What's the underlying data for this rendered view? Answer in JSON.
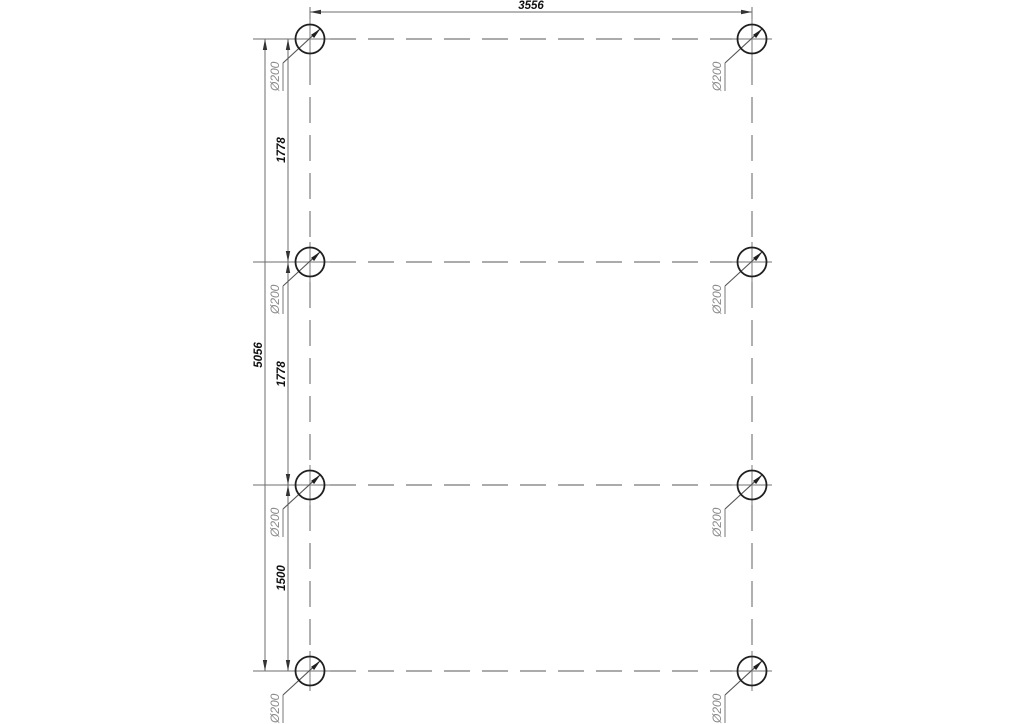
{
  "drawing": {
    "kind": "pile-layout-plan",
    "pile_count": 8,
    "pile_diameter_label": "Ø200",
    "top_dimension": {
      "label": "3556"
    },
    "left_total_dimension": {
      "label": "5056"
    },
    "left_chain_dimensions": [
      {
        "label": "1778"
      },
      {
        "label": "1778"
      },
      {
        "label": "1500"
      }
    ],
    "colors": {
      "background": "#ffffff",
      "pile_outline": "#1f1f1f",
      "centerline_gray": "#8f8f8f",
      "dimension_gray": "#6e6e6e",
      "dimension_text": "#111111",
      "diameter_text": "#8a8a8a"
    }
  }
}
